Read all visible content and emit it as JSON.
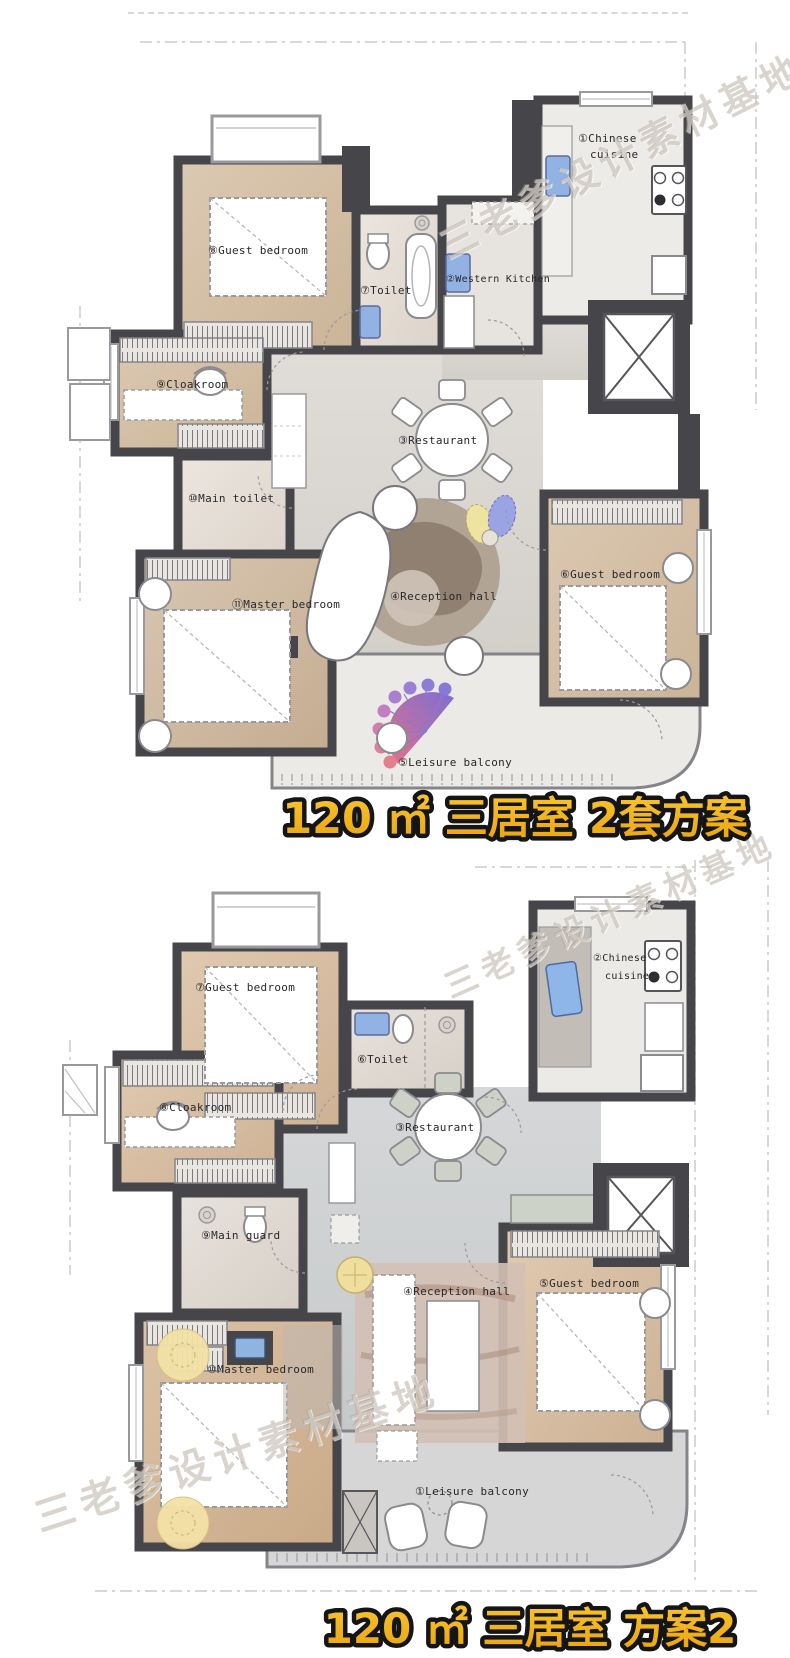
{
  "watermark": {
    "text": "三老爹设计素材基地"
  },
  "plan1": {
    "title": "120 ㎡ 三居室 2套方案",
    "labels": {
      "chinese_cuisine_1": "①Chinese",
      "chinese_cuisine_2": "cuisine",
      "western_kitchen": "②Western Kitchen",
      "restaurant": "③Restaurant",
      "reception_hall": "④Reception hall",
      "leisure_balcony": "⑤Leisure balcony",
      "guest_bedroom_right": "⑥Guest bedroom",
      "toilet": "⑦Toilet",
      "guest_bedroom_top": "⑧Guest bedroom",
      "cloakroom": "⑨Cloakroom",
      "main_toilet": "⑩Main toilet",
      "master_bedroom": "⑪Master bedroom"
    }
  },
  "plan2": {
    "title": "120 ㎡ 三居室 方案2",
    "labels": {
      "leisure_balcony": "①Leisure balcony",
      "chinese_cuisine_1": "②Chinese",
      "chinese_cuisine_2": "cuisine",
      "restaurant": "③Restaurant",
      "reception_hall": "④Reception hall",
      "guest_bedroom_right": "⑤Guest bedroom",
      "toilet": "⑥Toilet",
      "guest_bedroom_top": "⑦Guest bedroom",
      "cloakroom": "⑧Cloakroom",
      "main_guard": "⑨Main guard",
      "master_bedroom": "⑩Master bedroom"
    }
  },
  "colors": {
    "wall": "#46464a",
    "wood_floor": "#d6c3ad",
    "marble_floor": "#e9e2db",
    "hall_floor_plan1": "#dcd9d4",
    "hall_floor_plan2": "#d0d2d3",
    "sink_blue": "#93b2e4",
    "title_fill": "#f3b31c",
    "title_outline": "#151515"
  }
}
